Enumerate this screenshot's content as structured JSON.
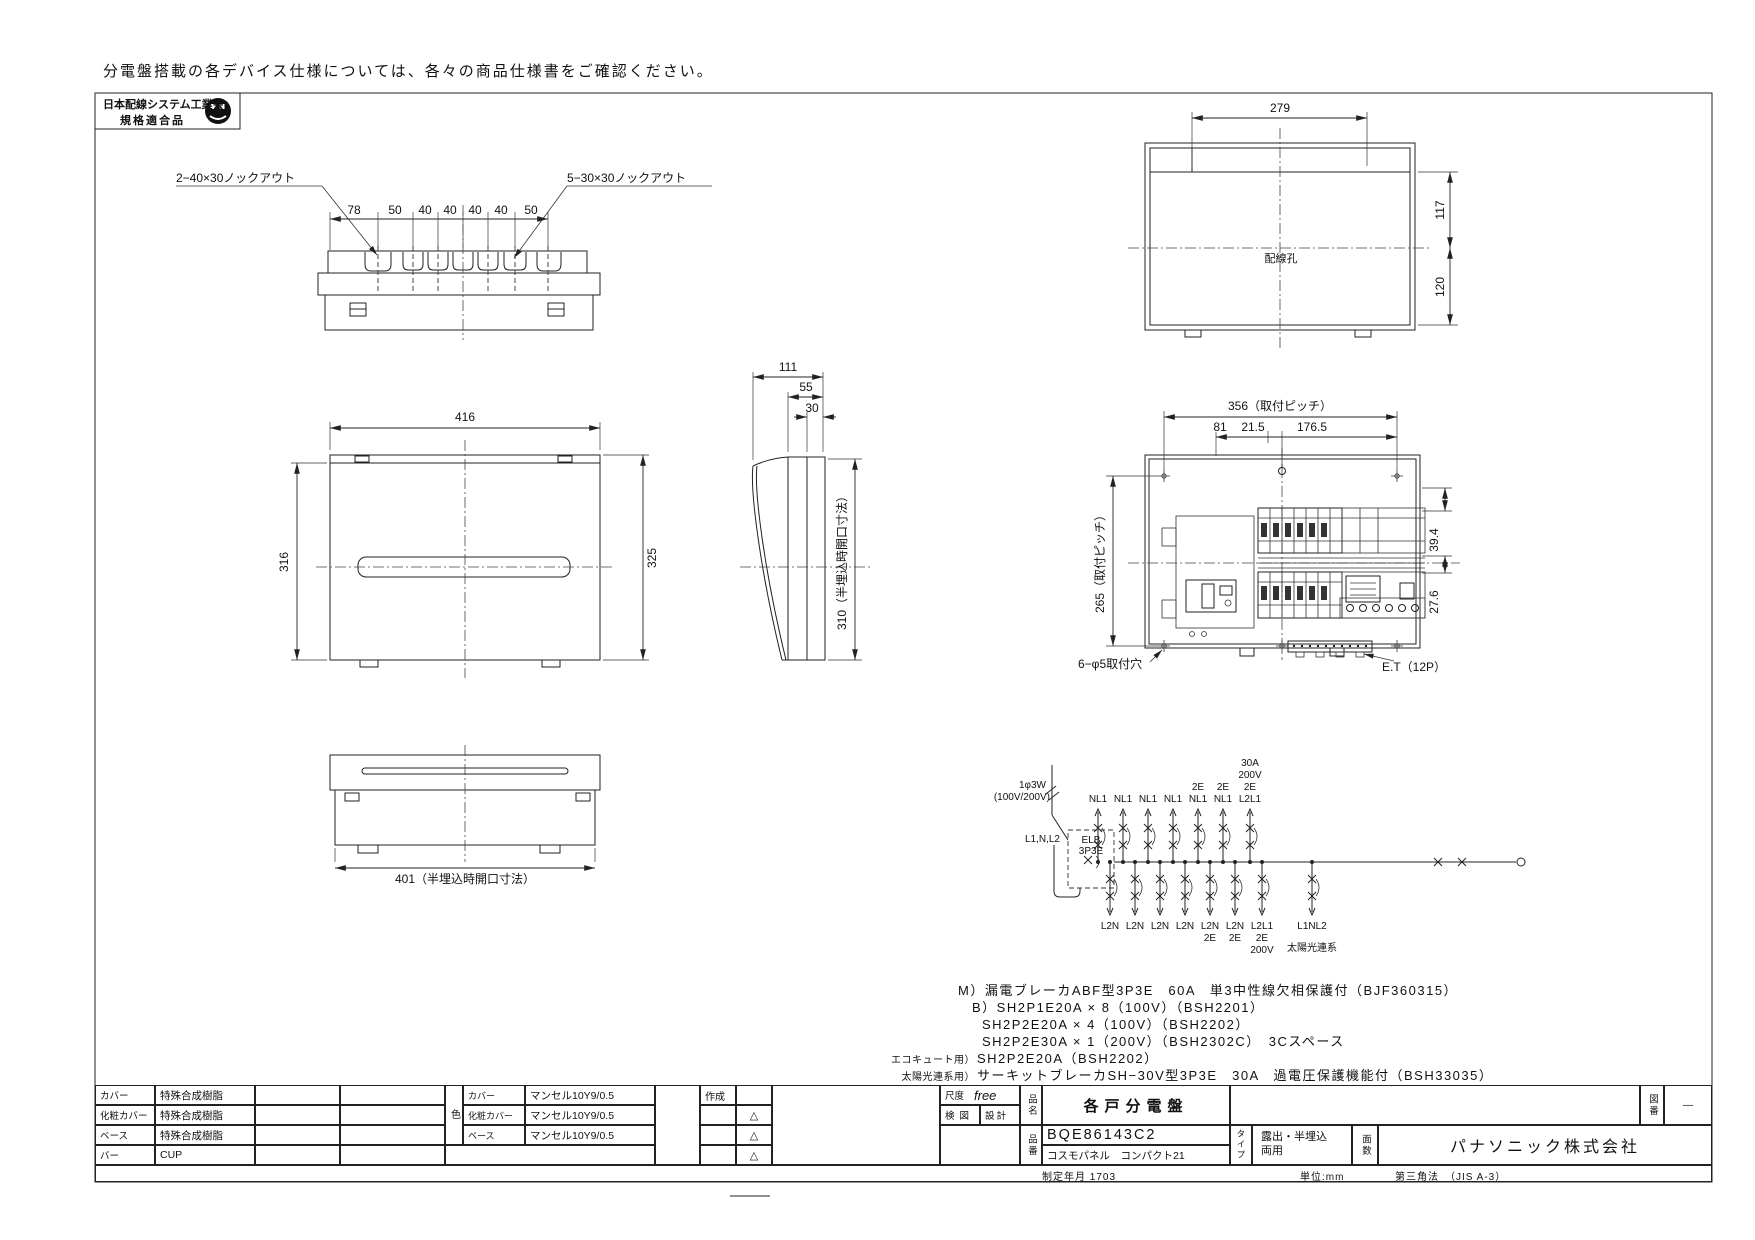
{
  "note_top": "分電盤搭載の各デバイス仕様については、各々の商品仕様書をご確認ください。",
  "logo": {
    "line1": "日本配線システム工業会",
    "line2": "規格適合品"
  },
  "views": {
    "knockout": {
      "leader_left": "2−40×30ノックアウト",
      "leader_right": "5−30×30ノックアウト",
      "dims": [
        "78",
        "50",
        "40",
        "40",
        "40",
        "40",
        "50"
      ]
    },
    "back": {
      "width": "279",
      "upper": "117",
      "lower": "120",
      "hole": "配線孔"
    },
    "front": {
      "width": "416",
      "height_left": "316",
      "height_right": "325"
    },
    "side": {
      "depth": "111",
      "d55": "55",
      "d30": "30",
      "opening": "310（半埋込時開口寸法）"
    },
    "bottom": {
      "opening": "401（半埋込時開口寸法）"
    },
    "panel": {
      "pitch_w": "356（取付ピッチ）",
      "d81": "81",
      "d215": "21.5",
      "d1765": "176.5",
      "pitch_h": "265（取付ピッチ）",
      "d394": "39.4",
      "d276": "27.6",
      "holes": "6−φ5取付穴",
      "et": "E.T（12P）"
    }
  },
  "circuit": {
    "source1": "1φ3W",
    "source2": "(100V/200V)",
    "phase": "L1,N,L2",
    "elb1": "ELB",
    "elb2": "3P3E",
    "top_nl1": [
      "NL1",
      "NL1",
      "NL1",
      "NL1"
    ],
    "top_2e": [
      [
        "2E",
        "NL1"
      ],
      [
        "2E",
        "NL1"
      ]
    ],
    "stack200v": [
      "30A",
      "200V",
      "2E",
      "L2L1"
    ],
    "bottom_l2n": [
      "L2N",
      "L2N",
      "L2N",
      "L2N"
    ],
    "bottom_2e": [
      [
        "L2N",
        "2E"
      ],
      [
        "L2N",
        "2E"
      ]
    ],
    "bottom_200v": [
      "L2L1",
      "2E",
      "200V"
    ],
    "solar_top": "L1NL2",
    "solar": "太陽光連系"
  },
  "notes": {
    "m": "M）漏電ブレーカABF型3P3E　60A　単3中性線欠相保護付（BJF360315）",
    "b1": "B）SH2P1E20A × 8（100V）（BSH2201）",
    "b2": "SH2P2E20A × 4（100V）（BSH2202）",
    "b3": "SH2P2E30A × 1（200V）（BSH2302C）　3Cスペース",
    "eco_prefix": "エコキュート用）",
    "eco": "SH2P2E20A（BSH2202）",
    "solar_prefix": "太陽光連系用）",
    "solar": "サーキットブレーカSH−30V型3P3E　30A　過電圧保護機能付（BSH33035）"
  },
  "titleblock": {
    "materials": [
      [
        "カバー",
        "特殊合成樹脂"
      ],
      [
        "化粧カバー",
        "特殊合成樹脂"
      ],
      [
        "ベース",
        "特殊合成樹脂"
      ],
      [
        "バー",
        "CUP"
      ]
    ],
    "color_header": "色",
    "colors": [
      [
        "カバー",
        "マンセル10Y9/0.5"
      ],
      [
        "化粧カバー",
        "マンセル10Y9/0.5"
      ],
      [
        "ベース",
        "マンセル10Y9/0.5"
      ]
    ],
    "sakusei": "作成",
    "revision_mark": "△",
    "scale_label": "尺度",
    "scale_value": "free",
    "check_label": "検図",
    "design_label": "設計",
    "name_label": "品名",
    "product_name": "各戸分電盤",
    "number_label": "品番",
    "product_number": "BQE86143C2",
    "series_name": "コスモパネル　コンパクト21",
    "type_label": "タイプ",
    "type_value1": "露出・半埋込",
    "type_value2": "両用",
    "faces_label": "面数",
    "drawing_no_label": "図番",
    "drawing_no_value": "—",
    "company": "パナソニック株式会社",
    "established": "制定年月 1703",
    "unit": "単位:mm",
    "projection": "第三角法　（JIS A-3）"
  }
}
